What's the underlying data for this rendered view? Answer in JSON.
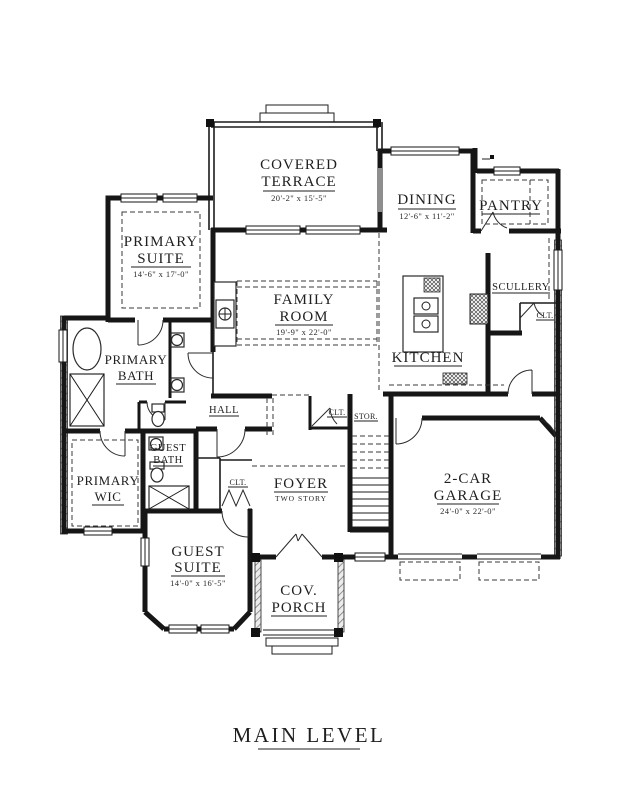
{
  "plan": {
    "title": "MAIN LEVEL",
    "ink_color": "#1f1f1f",
    "rooms": {
      "covered_terrace": {
        "name1": "COVERED",
        "name2": "TERRACE",
        "dims": "20'-2\" x 15'-5\""
      },
      "dining": {
        "name1": "DINING",
        "dims": "12'-6\" x 11'-2\""
      },
      "pantry": {
        "name1": "PANTRY"
      },
      "primary_suite": {
        "name1": "PRIMARY",
        "name2": "SUITE",
        "dims": "14'-6\" x 17'-0\""
      },
      "family_room": {
        "name1": "FAMILY",
        "name2": "ROOM",
        "dims": "19'-9\" x 22'-0\""
      },
      "kitchen": {
        "name1": "KITCHEN"
      },
      "scullery": {
        "name1": "SCULLERY"
      },
      "primary_bath": {
        "name1": "PRIMARY",
        "name2": "BATH"
      },
      "primary_wic": {
        "name1": "PRIMARY",
        "name2": "WIC"
      },
      "guest_bath": {
        "name1": "GUEST",
        "name2": "BATH"
      },
      "hall": {
        "name1": "HALL"
      },
      "foyer": {
        "name1": "FOYER",
        "name2": "TWO STORY"
      },
      "stor": {
        "name1": "STOR."
      },
      "closet_hall": {
        "name1": "CLT."
      },
      "closet_foyer": {
        "name1": "CLT."
      },
      "closet_scullery": {
        "name1": "CLT."
      },
      "garage": {
        "name1": "2-CAR",
        "name2": "GARAGE",
        "dims": "24'-0\" x 22'-0\""
      },
      "guest_suite": {
        "name1": "GUEST",
        "name2": "SUITE",
        "dims": "14'-0\" x 16'-5\""
      },
      "cov_porch": {
        "name1": "COV.",
        "name2": "PORCH"
      }
    }
  }
}
